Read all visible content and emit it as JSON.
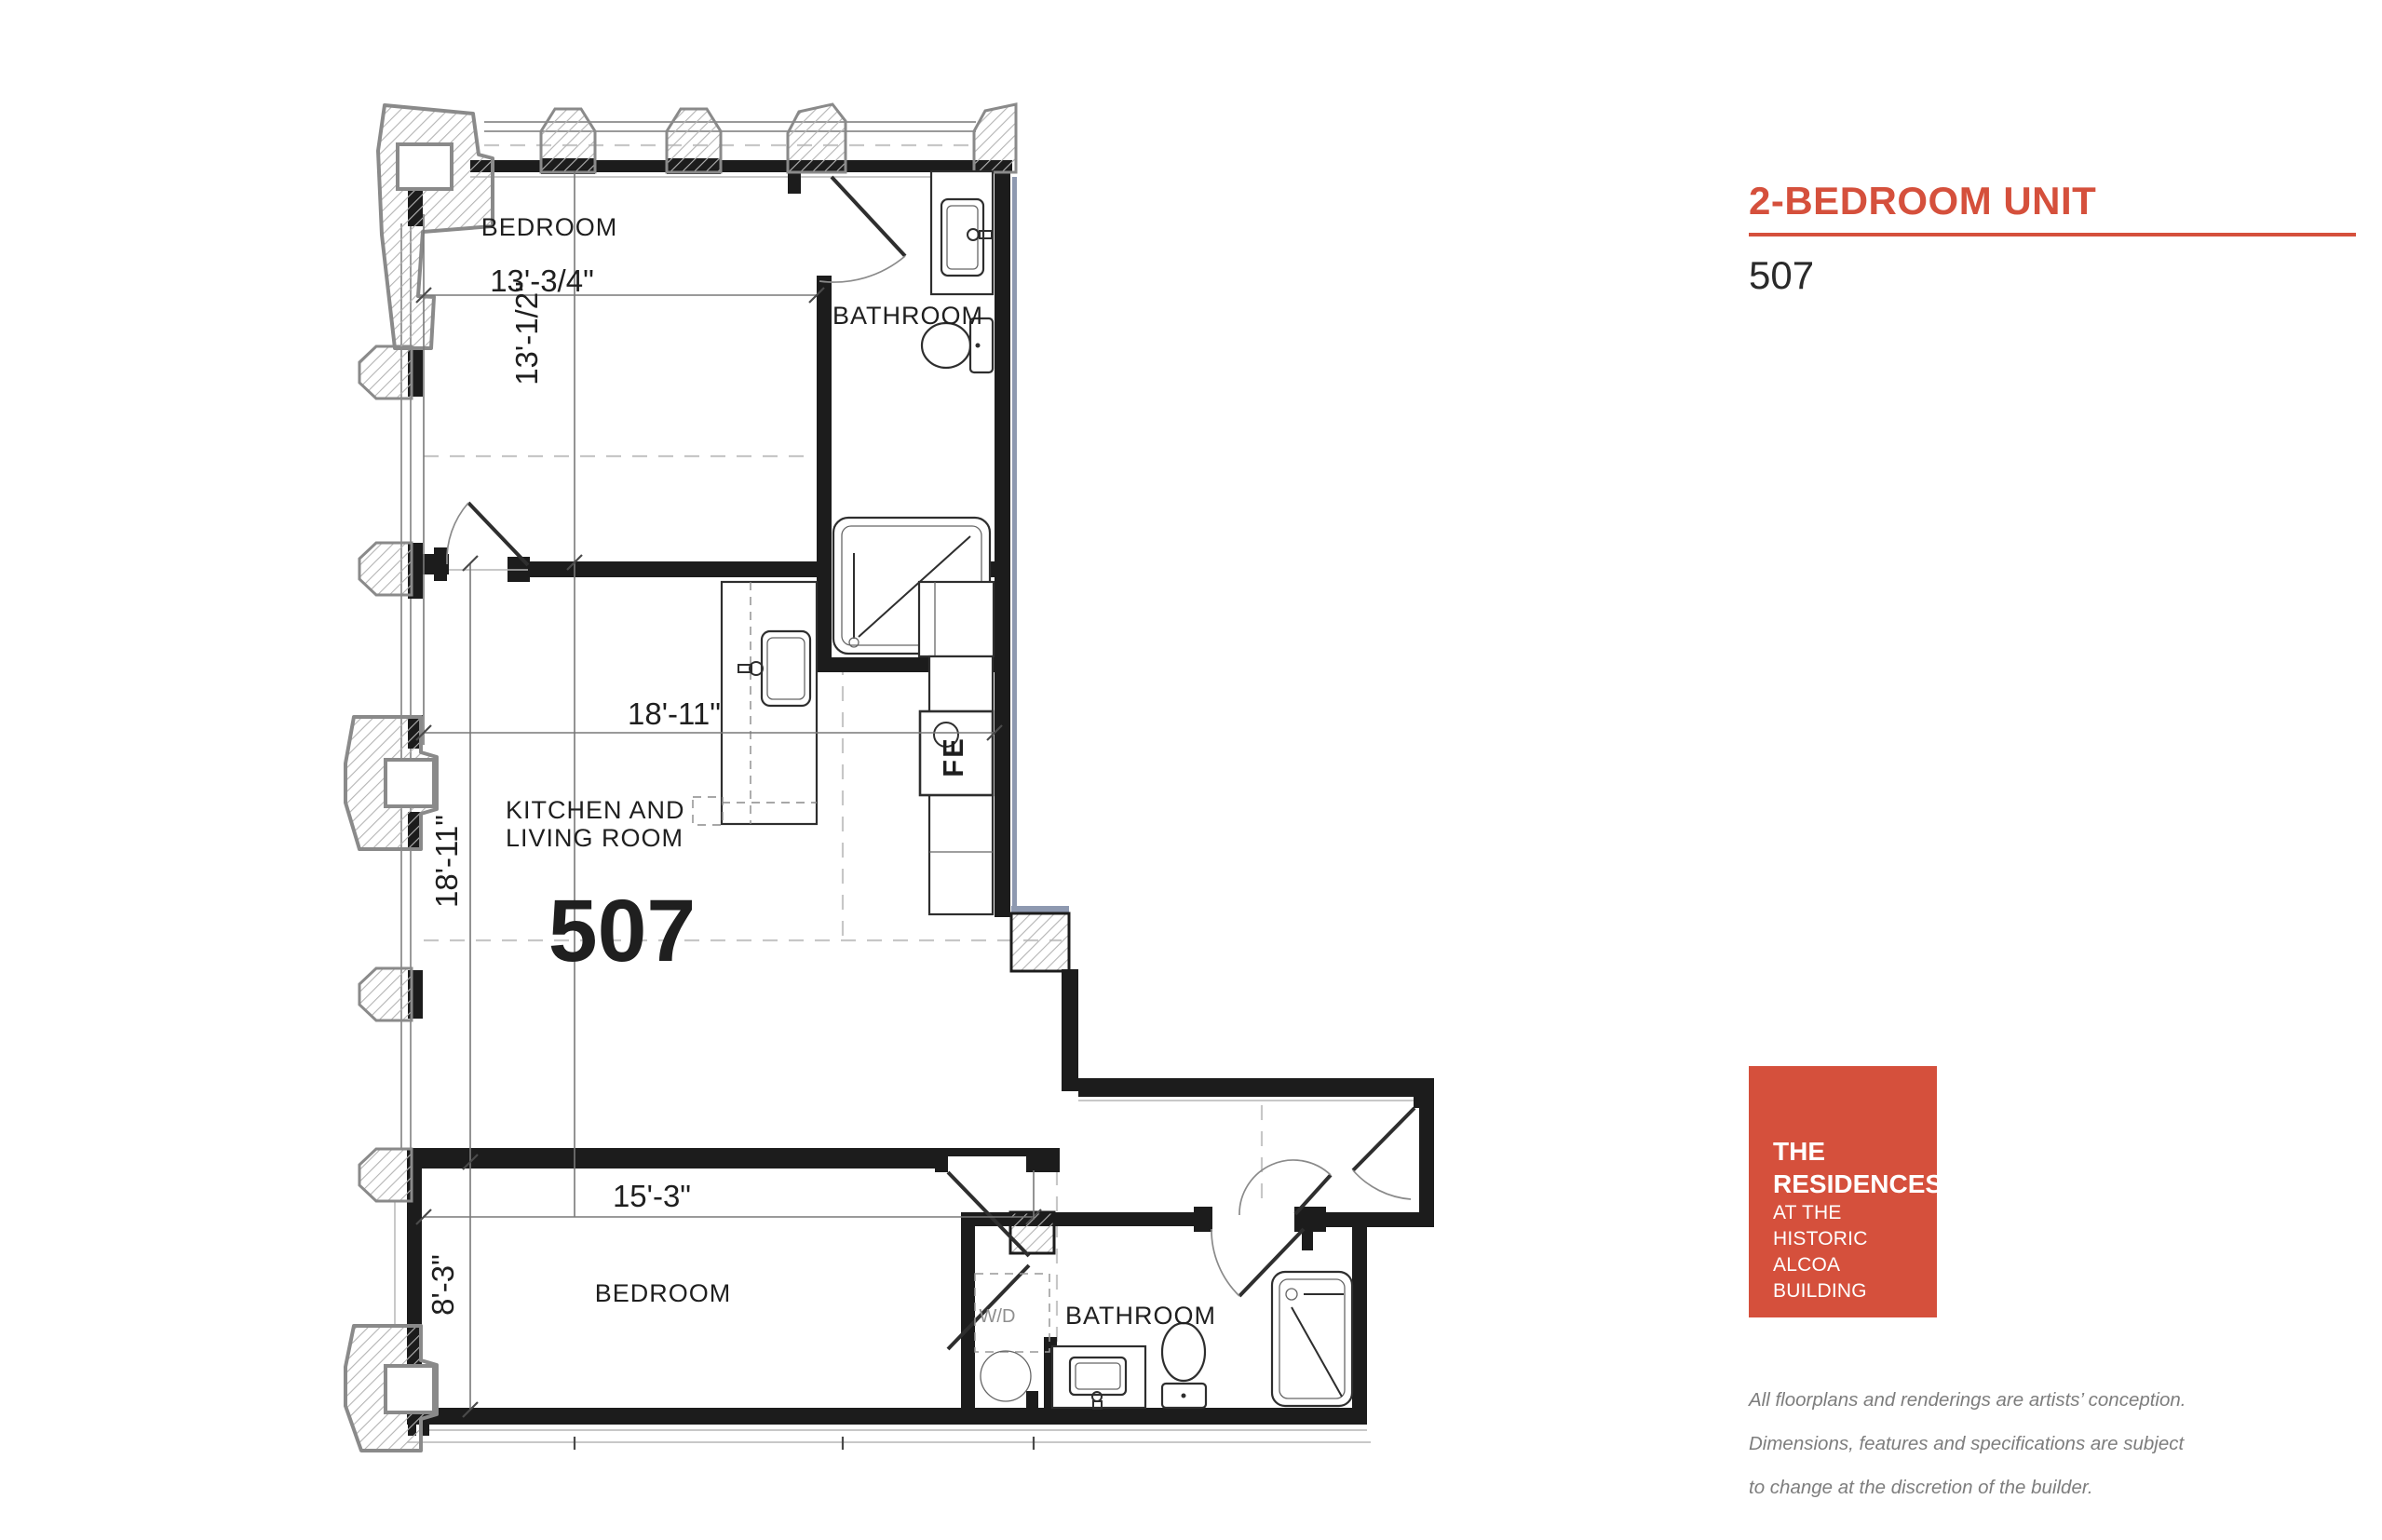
{
  "header": {
    "title": "2-BEDROOM UNIT",
    "unit_number": "507",
    "accent_color": "#d5503c"
  },
  "plan": {
    "unit_label": "507",
    "rooms": {
      "bedroom_top": "BEDROOM",
      "bathroom_top": "BATHROOM",
      "kitchen_line1": "KITCHEN AND",
      "kitchen_line2": "LIVING ROOM",
      "bedroom_bottom": "BEDROOM",
      "bathroom_bottom": "BATHROOM",
      "washer_dryer": "W/D",
      "fire_extinguisher": "FE"
    },
    "dimensions": {
      "bedroom_top_width": "13'-3/4\"",
      "bedroom_top_height": "13'-1/2\"",
      "living_width": "18'-11\"",
      "living_height": "18'-11\"",
      "bedroom_bottom_width": "15'-3\"",
      "bedroom_bottom_height": "8'-3\""
    }
  },
  "logo": {
    "line1": "THE",
    "line2": "RESIDENCES",
    "line3": "AT THE",
    "line4": "HISTORIC",
    "line5": "ALCOA BUILDING",
    "bg_color": "#d5503c"
  },
  "disclaimer": {
    "line1": "All floorplans and renderings are artists’ conception.",
    "line2": "Dimensions, features and specifications are subject",
    "line3": "to change at the discretion of the builder."
  }
}
